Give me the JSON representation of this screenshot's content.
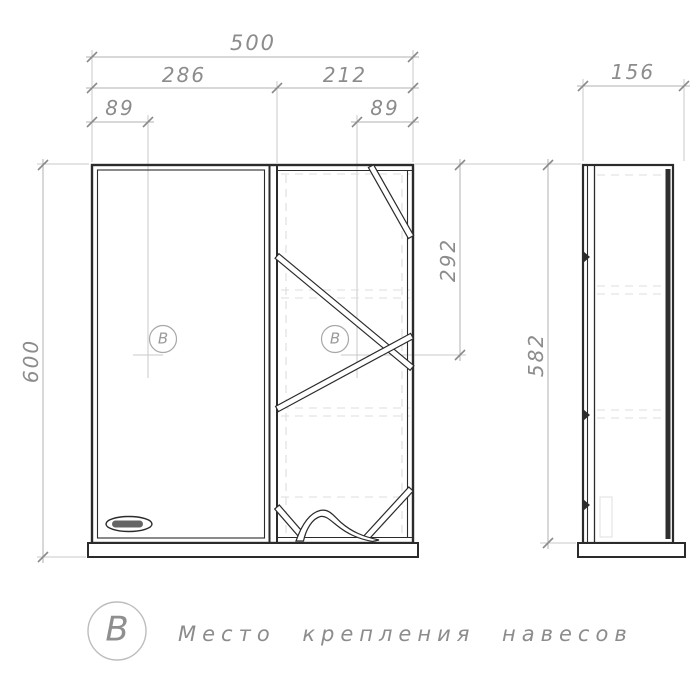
{
  "drawing": {
    "front_view": {
      "dimensions": {
        "total_width": "500",
        "left_section_width": "286",
        "right_section_width": "212",
        "hanger_offset_left": "89",
        "hanger_offset_right": "89",
        "total_height": "600",
        "hanger_drop": "292"
      },
      "hanger_symbol_left": "В",
      "hanger_symbol_right": "В"
    },
    "side_view": {
      "dimensions": {
        "depth": "156",
        "body_height": "582"
      }
    },
    "legend": {
      "symbol": "В",
      "label": "Место крепления навесов"
    },
    "colors": {
      "object_line": "#2b2b2b",
      "dimension_line": "#b2b2b2",
      "extension_line": "#c9c9c9",
      "hidden_line": "#dcdcdc",
      "dimension_text": "#8c8c8c",
      "symbol_stroke": "#a8a8a8"
    }
  }
}
